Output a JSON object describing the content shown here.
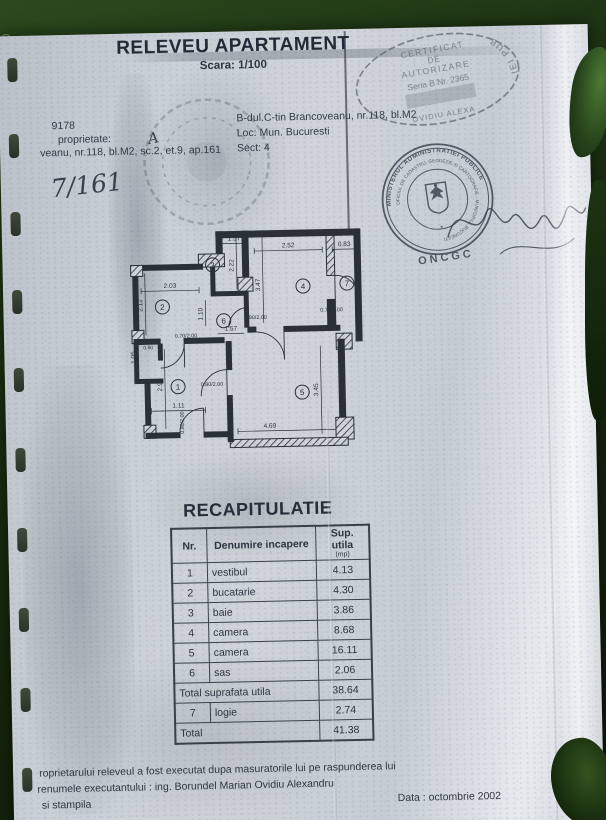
{
  "colors": {
    "ink": "#2e3440",
    "paper": "#cdd3da",
    "foliage": "#24401a"
  },
  "document": {
    "title": "RELEVEU APARTAMENT",
    "scale": "Scara: 1/100",
    "ref_number": "9178",
    "owner_label": "proprietate:",
    "owner_line": "veanu, nr.118, bl.M2, sc.2, et.9, ap.161",
    "handwritten_note": "7/161",
    "address_line1": "B-dul.C-tin Brancoveanu, nr.118, bl.M2",
    "address_line2": "Loc:  Mun. Bucuresti",
    "address_line3": "Sect: 4"
  },
  "stamps": {
    "certificate": {
      "l1": "CERTIFICAT",
      "l2": "DE",
      "l3": "AUTORIZARE",
      "l4": "Seria B Nr. 2365",
      "l5": "OVIDIU ALEXA",
      "ring_fragment": "IEI PUB"
    },
    "ministry": {
      "top_arc": "MINISTERUL ADMINISTRATIEI PUBLICE",
      "inner_arc": "OFICIUL DE CADASTRU, GEODEZIE SI CARTOGRAFIE - MUNICIPIUL BUCURESTI",
      "bottom": "ONCGC"
    }
  },
  "plan": {
    "rooms": [
      "1",
      "2",
      "3",
      "4",
      "5",
      "6",
      "7"
    ],
    "dims": {
      "top1": "1.57",
      "top2": "2.52",
      "top3": "0.83",
      "r3h": "2.22",
      "r4h": "3.47",
      "r2w": "2.03",
      "r2h": "2.12",
      "door6": "0.90/2.00",
      "r6w": "1.57",
      "r6h": "1.10",
      "door7": "0.70/2.00",
      "door1t": "0.70/2.00",
      "door1r": "0.80/2.00",
      "door1b": "0.80/2.00",
      "r1w": "1.11",
      "r1h": "2.96",
      "r5w": "4.69",
      "r5h": "3.45",
      "niche_h": "1.05",
      "niche_w": "0.80"
    }
  },
  "table": {
    "title": "RECAPITULATIE",
    "headers": {
      "nr": "Nr.",
      "name": "Denumire incapere",
      "area": "Sup. utila",
      "area_unit": "(mp)"
    },
    "rows": [
      {
        "nr": "1",
        "name": "vestibul",
        "area": "4.13"
      },
      {
        "nr": "2",
        "name": "bucatarie",
        "area": "4.30"
      },
      {
        "nr": "3",
        "name": "baie",
        "area": "3.86"
      },
      {
        "nr": "4",
        "name": "camera",
        "area": "8.68"
      },
      {
        "nr": "5",
        "name": "camera",
        "area": "16.11"
      },
      {
        "nr": "6",
        "name": "sas",
        "area": "2.06"
      }
    ],
    "subtotal_label": "Total suprafata utila",
    "subtotal": "38.64",
    "row7": {
      "nr": "7",
      "name": "logie",
      "area": "2.74"
    },
    "total_label": "Total",
    "total": "41.38"
  },
  "footer": {
    "line1": "roprietarului releveul a fost executat dupa masuratorile lui pe raspunderea lui",
    "line2": "renumele executantului :  ing. Borundel Marian Ovidiu Alexandru",
    "line3": "si stampila",
    "date": "Data :  octombrie 2002"
  }
}
